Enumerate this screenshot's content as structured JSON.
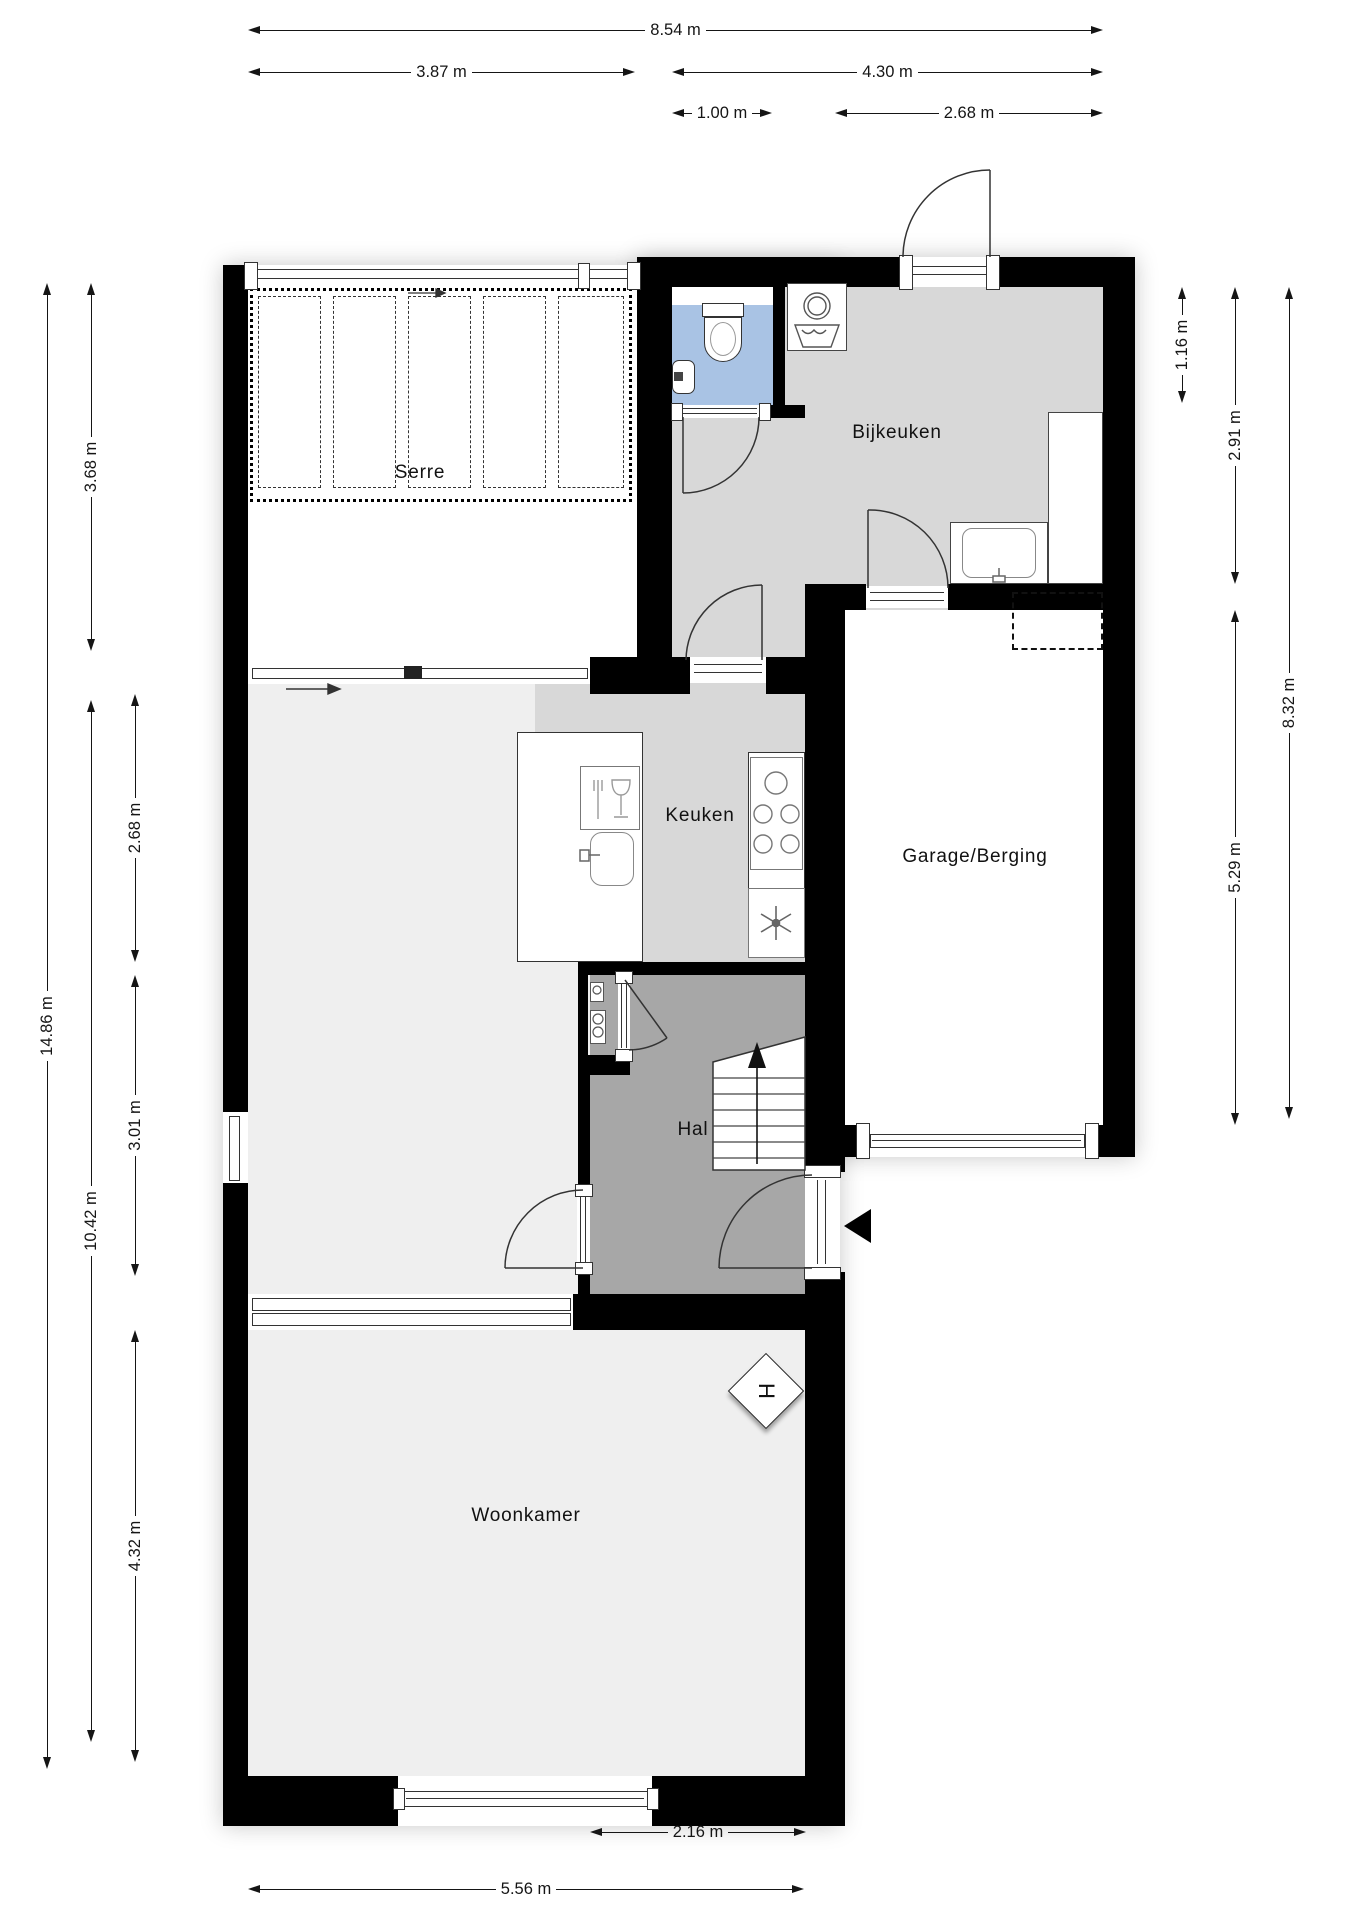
{
  "title": "Begane grond plattegrond",
  "rooms": {
    "serre": "Serre",
    "bijkeuken": "Bijkeuken",
    "keuken": "Keuken",
    "garage": "Garage/Berging",
    "hal": "Hal",
    "woonkamer": "Woonkamer"
  },
  "markers": {
    "fireplace": "H"
  },
  "dims": {
    "top": {
      "total": "8.54 m",
      "left": "3.87 m",
      "right": "4.30 m",
      "toilet": "1.00 m",
      "bijkeuken": "2.68 m"
    },
    "left": {
      "total": "14.86 m",
      "lower": "10.42 m",
      "serre": "3.68 m",
      "zone1": "2.68 m",
      "zone2": "3.01 m",
      "woonkamer": "4.32 m"
    },
    "right": {
      "toilet": "1.16 m",
      "bijkeuken": "2.91 m",
      "garage": "5.29 m",
      "total": "8.32 m"
    },
    "bottom": {
      "hal": "2.16 m",
      "woonkamer": "5.56 m"
    }
  },
  "fixtures": [
    "toilet",
    "hand-basin",
    "washing-machine",
    "laundry-tub",
    "kitchen-sink",
    "dishwasher",
    "cooktop",
    "extractor-fan",
    "utility-sink",
    "tall-cabinet",
    "meter-cabinet",
    "staircase",
    "fireplace-marker",
    "entrance-arrow"
  ],
  "colors": {
    "wall": "#000000",
    "floor_light": "#efefef",
    "floor_mid": "#d8d8d8",
    "floor_dark": "#a7a7a7",
    "toilet_floor": "#a9c3e4",
    "dim_text": "#151515"
  }
}
